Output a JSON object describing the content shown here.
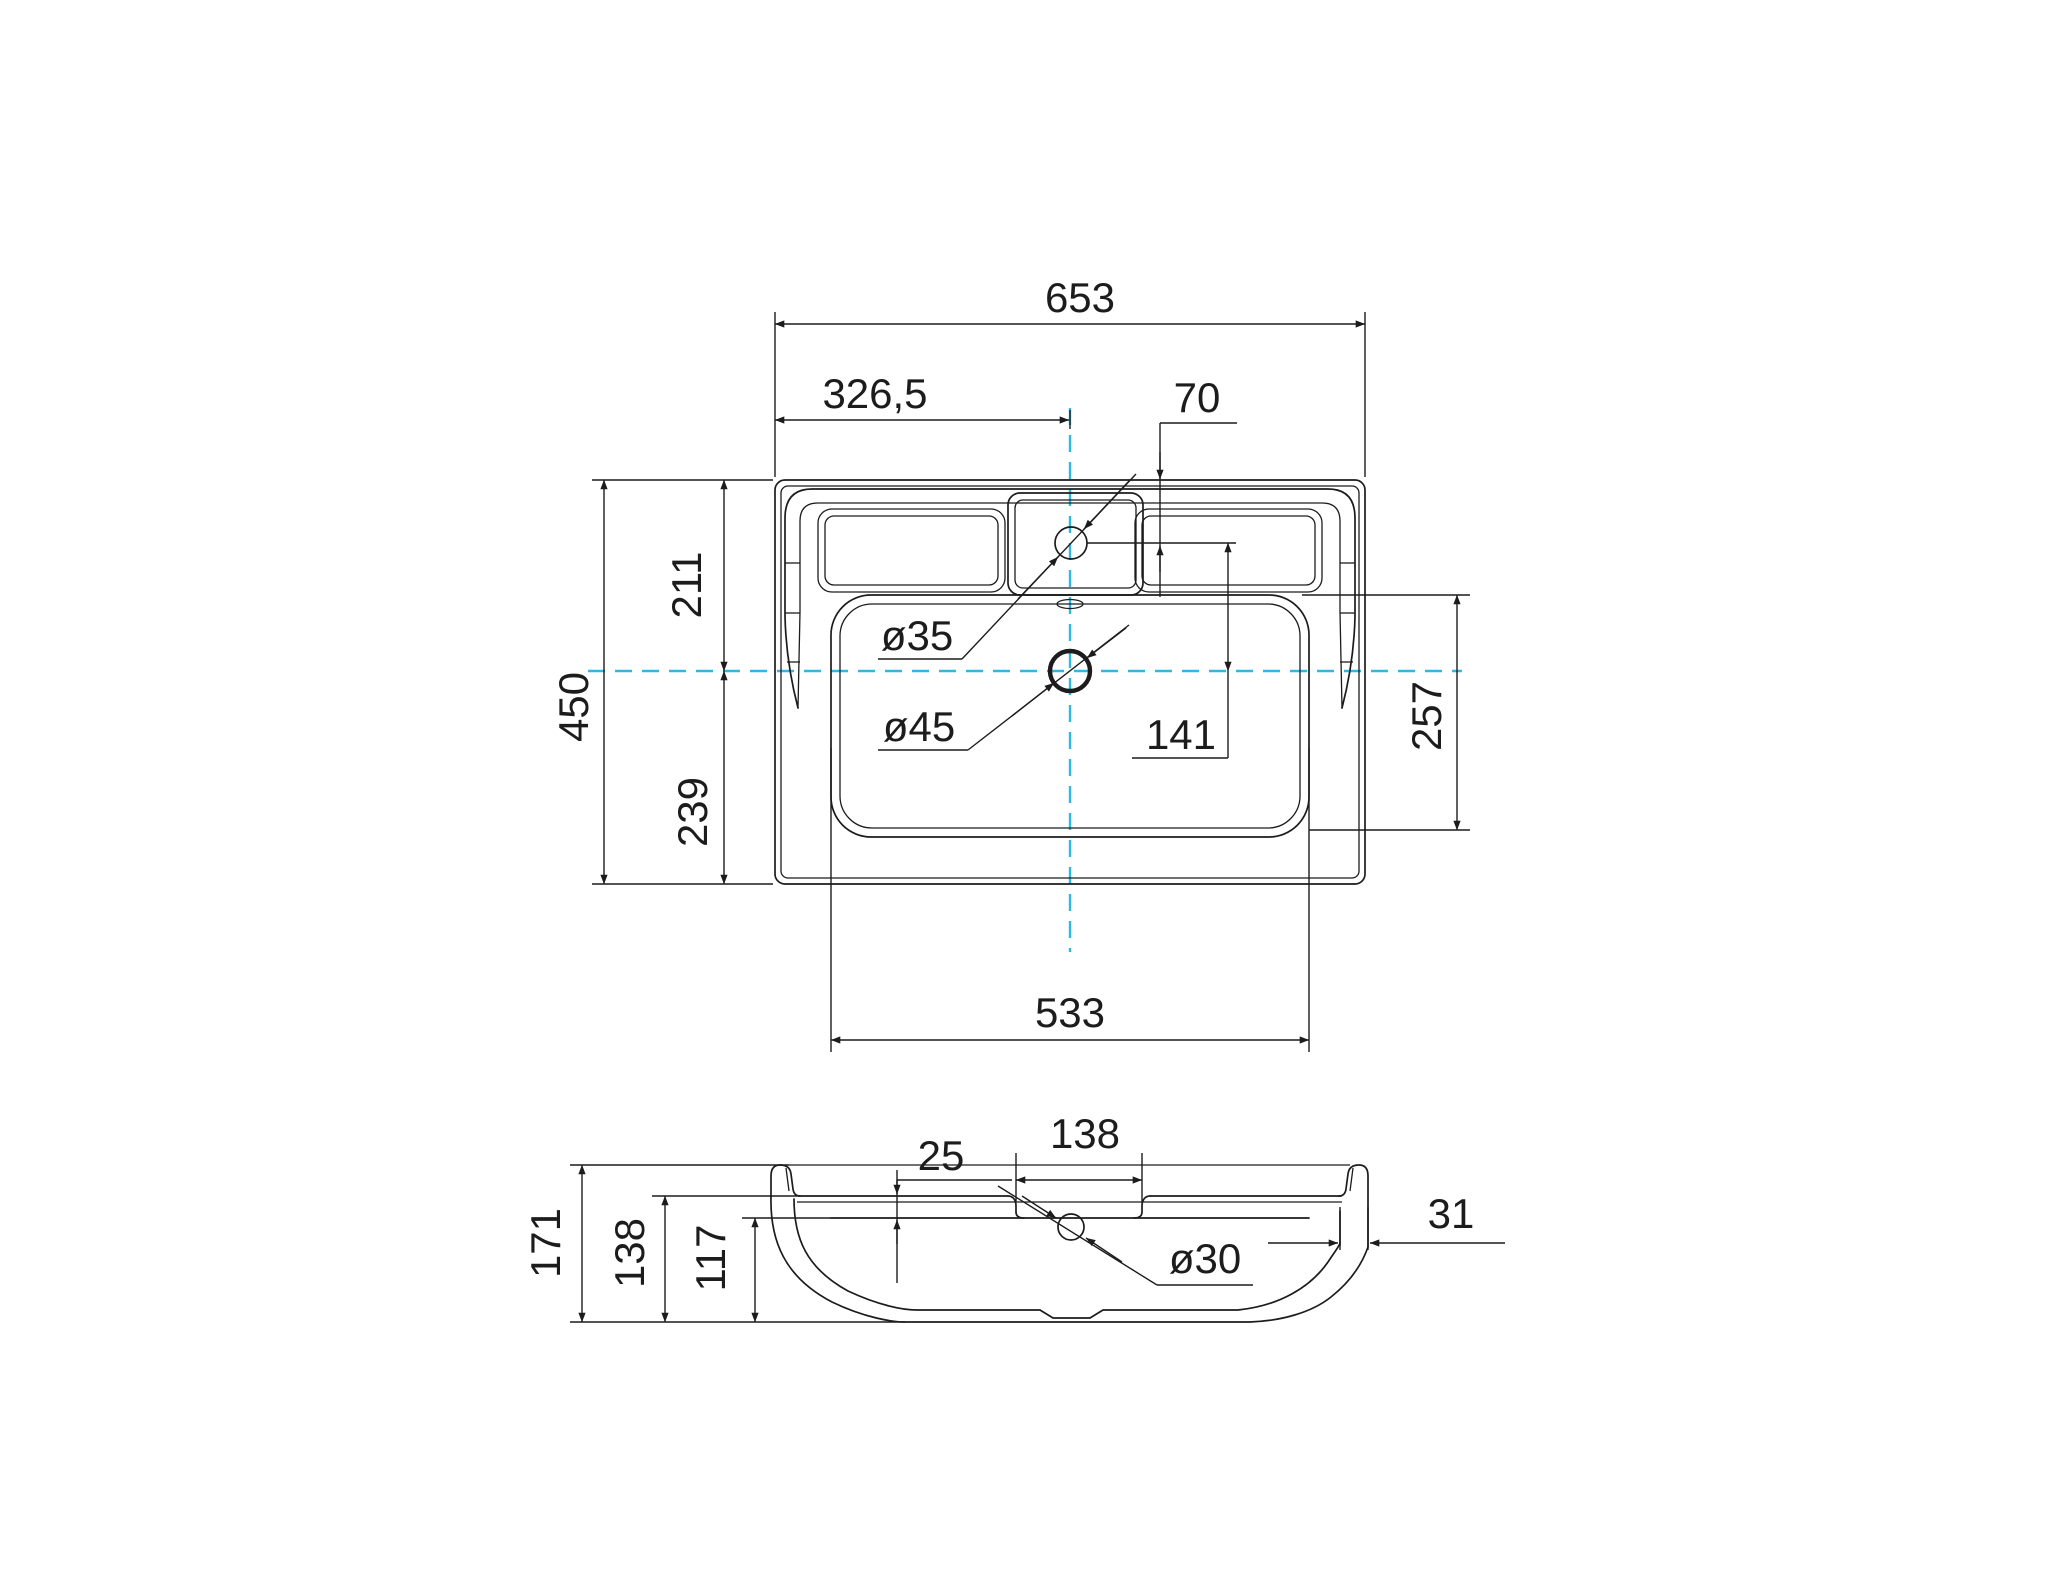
{
  "drawing": {
    "type": "technical-drawing",
    "subject": "washbasin two-view dimension drawing",
    "colors": {
      "background": "#ffffff",
      "line": "#1c1c1c",
      "centerline": "#2fb9e2"
    },
    "top_view": {
      "overall_width": "653",
      "center_offset": "326,5",
      "faucet_setback": "70",
      "overall_depth": "450",
      "back_to_centerline": "211",
      "centerline_to_front": "239",
      "bowl_width": "533",
      "faucet_to_centerline": "141",
      "bowl_depth": "257",
      "faucet_hole_diameter": "ø35",
      "drain_hole_diameter": "ø45"
    },
    "section_view": {
      "recess_depth": "25",
      "recess_width": "138",
      "overall_height": "171",
      "deck_height": "138",
      "inner_height": "117",
      "hole_diameter": "ø30",
      "rim_wall": "31"
    }
  }
}
